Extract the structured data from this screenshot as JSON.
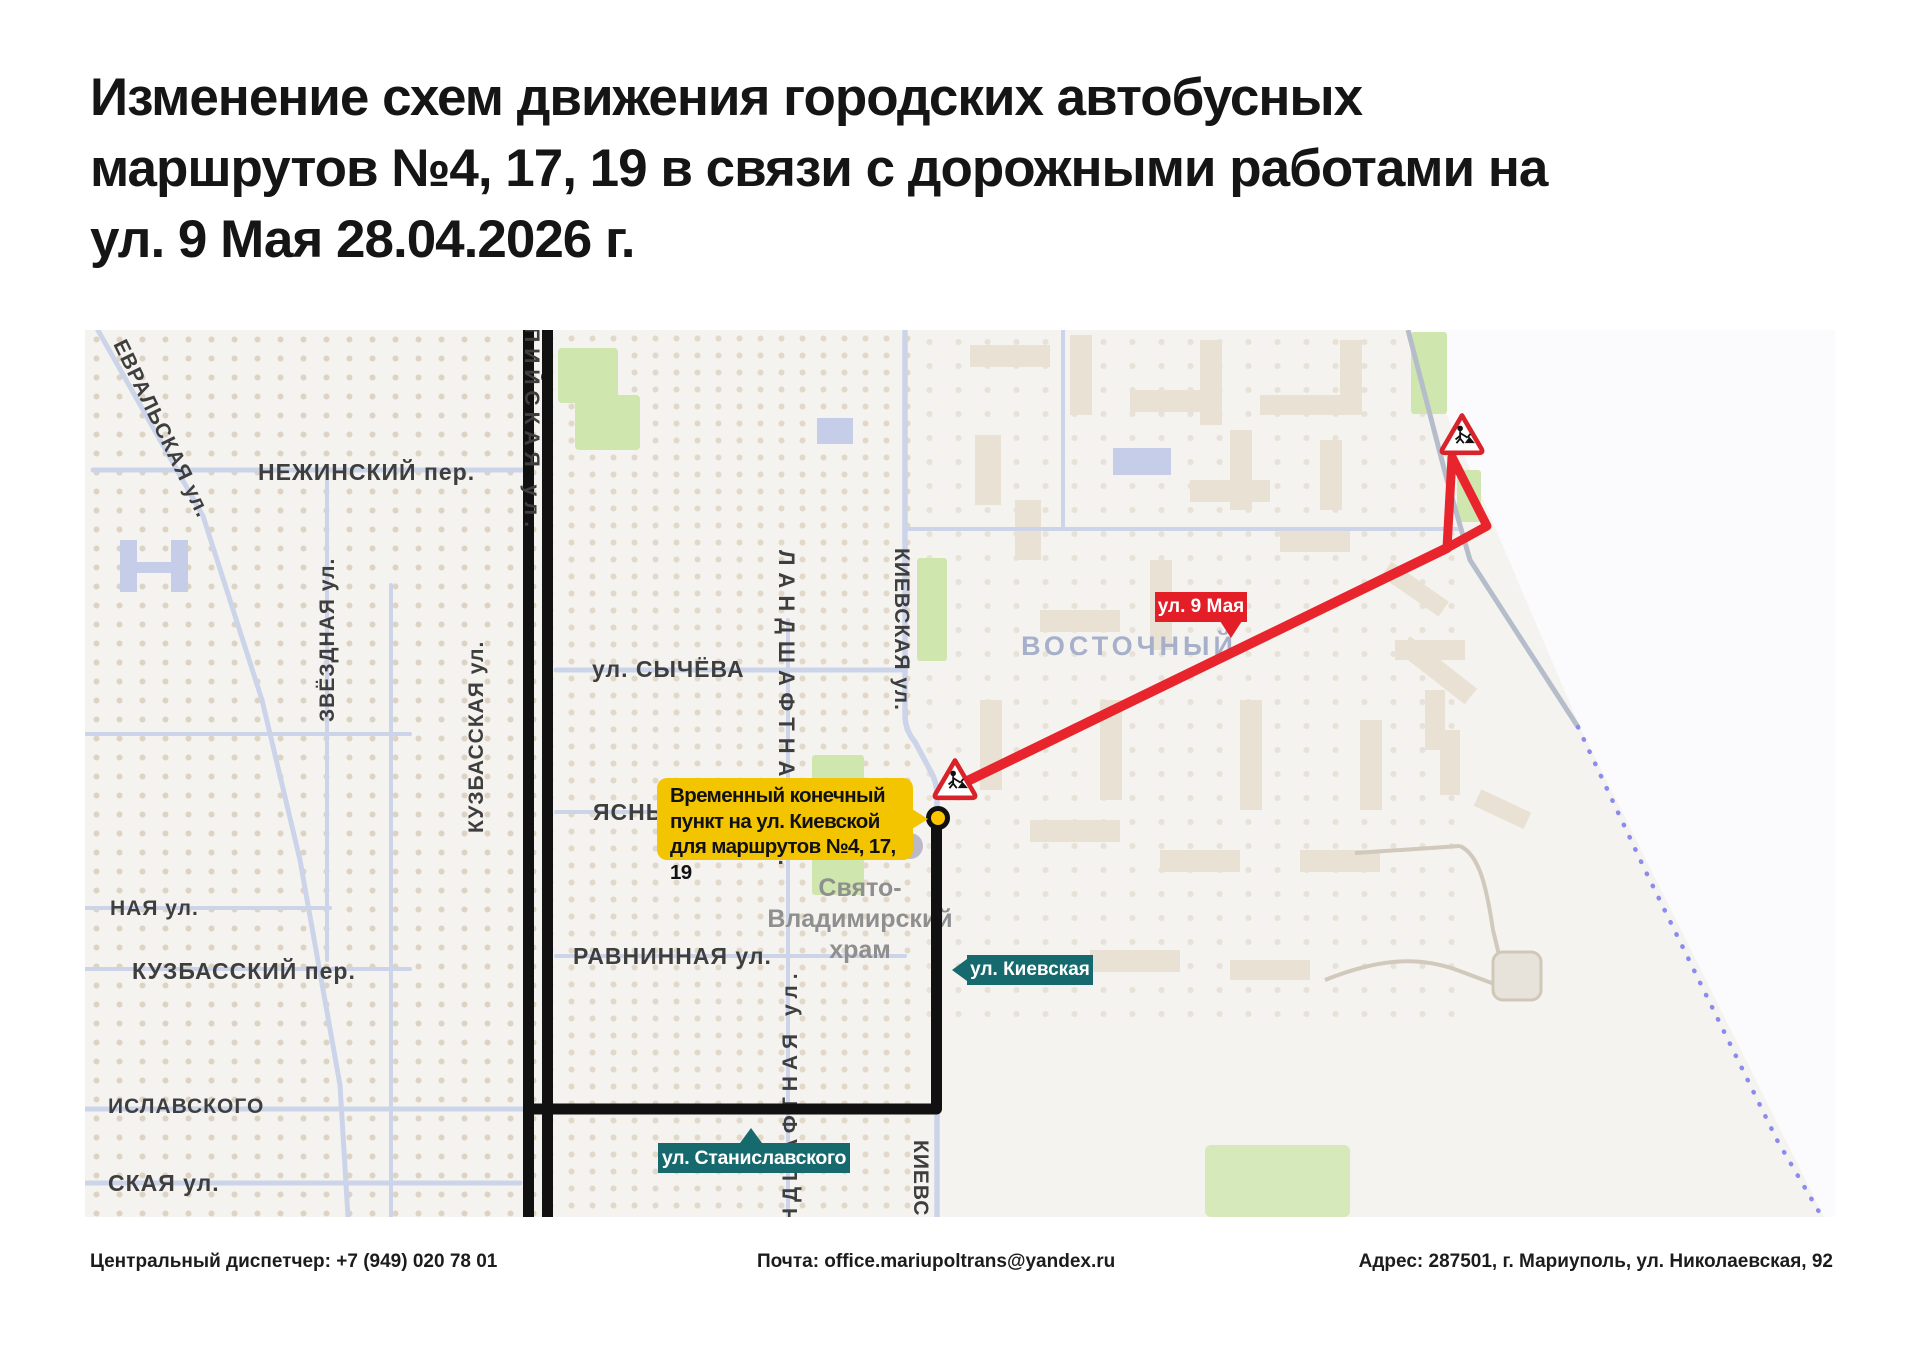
{
  "title": "Изменение схем движения городских автобусных\nмаршрутов №4, 17, 19 в связи с дорожными работами на\nул. 9 Мая 28.04.2026 г.",
  "map": {
    "streets": {
      "fevralskaya": "ЕВРАЛЬСКАЯ ул.",
      "nezhinsky": "НЕЖИНСКИЙ пер.",
      "zvezdnaya": "ЗВЁЗДНАЯ ул.",
      "kuzbasskaya": "КУЗБАССКАЯ ул.",
      "kuzbassky_per": "КУЗБАССКИЙ пер.",
      "naya": "НАЯ ул.",
      "stanislavskogo_map": "ИСЛАВСКОГО",
      "skaya": "СКАЯ ул.",
      "sychyova": "ул. СЫЧЁВА",
      "yasny": "ЯСНЫЙ пер.",
      "ravninnaya": "РАВНИННАЯ ул.",
      "olimpiyskaya": "ОЛИМПИЙСКАЯ ул.",
      "landshaftnaya": "ЛАНДШАФТНАЯ ул.",
      "kievskaya": "КИЕВСКАЯ ул."
    },
    "district": "ВОСТОЧНЫЙ",
    "church": {
      "line1": "Свято-",
      "line2": "Владимирский",
      "line3": "храм"
    },
    "callouts": {
      "terminal": "Временный конечный\nпункт на ул. Киевской\nдля маршрутов №4, 17, 19",
      "street_9_maya": "ул. 9 Мая",
      "kievskaya": "ул. Киевская",
      "stanislavskogo": "ул. Станиславского"
    },
    "icons": {
      "roadworks": "road-works-triangle-sign",
      "terminal_marker": "temporary-terminal-stop"
    }
  },
  "footer": {
    "dispatcher": "Центральный диспетчер: +7 (949) 020 78 01",
    "email": "Почта: office.mariupoltrans@yandex.ru",
    "address": "Адрес: 287501, г. Мариуполь, ул. Николаевская, 92"
  },
  "colors": {
    "route_closed_black": "#111111",
    "route_detour_red": "#e8252c",
    "callout_yellow": "#f3c400",
    "callout_teal": "#166a6e",
    "callout_red": "#e31e26",
    "district_text": "#a7b0ca",
    "boundary_dotted": "#8b8bef"
  }
}
